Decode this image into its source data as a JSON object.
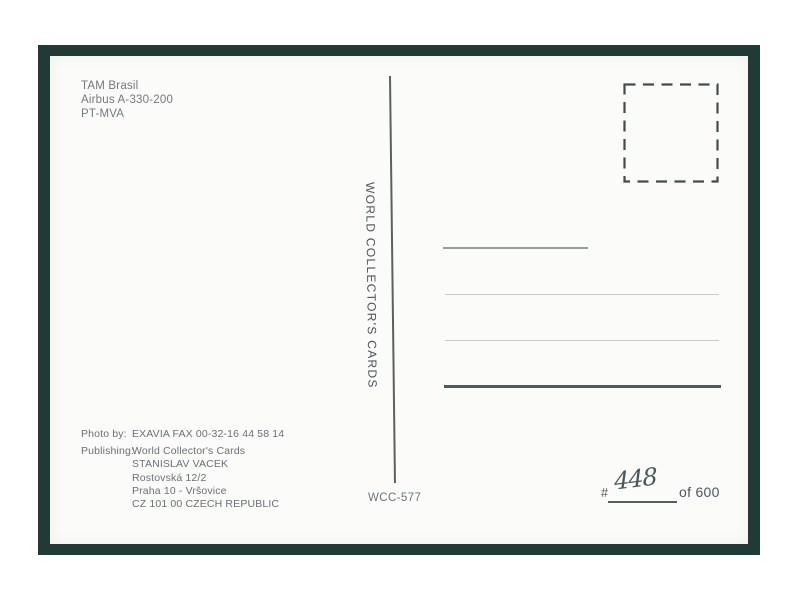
{
  "postcard": {
    "aircraft_info": [
      "TAM Brasil",
      "Airbus A-330-200",
      "PT-MVA"
    ],
    "brand_vertical_text": "WORLD COLLECTOR'S CARDS",
    "credits": {
      "photo_by_label": "Photo by:",
      "photo_by_value": "EXAVIA FAX 00-32-16 44 58 14",
      "publishing_label": "Publishing:",
      "publishing_lines": [
        "World Collector's Cards",
        "STANISLAV VACEK",
        "Rostovská 12/2",
        "Praha 10 - Vršovice",
        "CZ 101 00 CZECH REPUBLIC"
      ]
    },
    "card_number": "WCC-577",
    "edition": {
      "hash": "#",
      "handwritten_number": "448",
      "of_total": "of 600"
    }
  },
  "colors": {
    "frame": "#203a36",
    "card_background": "#fbfbf9",
    "print_gray": "#75797c",
    "print_dark": "#4b5457",
    "credits_gray": "#6b7175",
    "address_line_light": "#c6cbca",
    "address_line_dark": "#4e5a57",
    "stamp_dash": "#424d4b",
    "handwriting": "#4c575c"
  }
}
